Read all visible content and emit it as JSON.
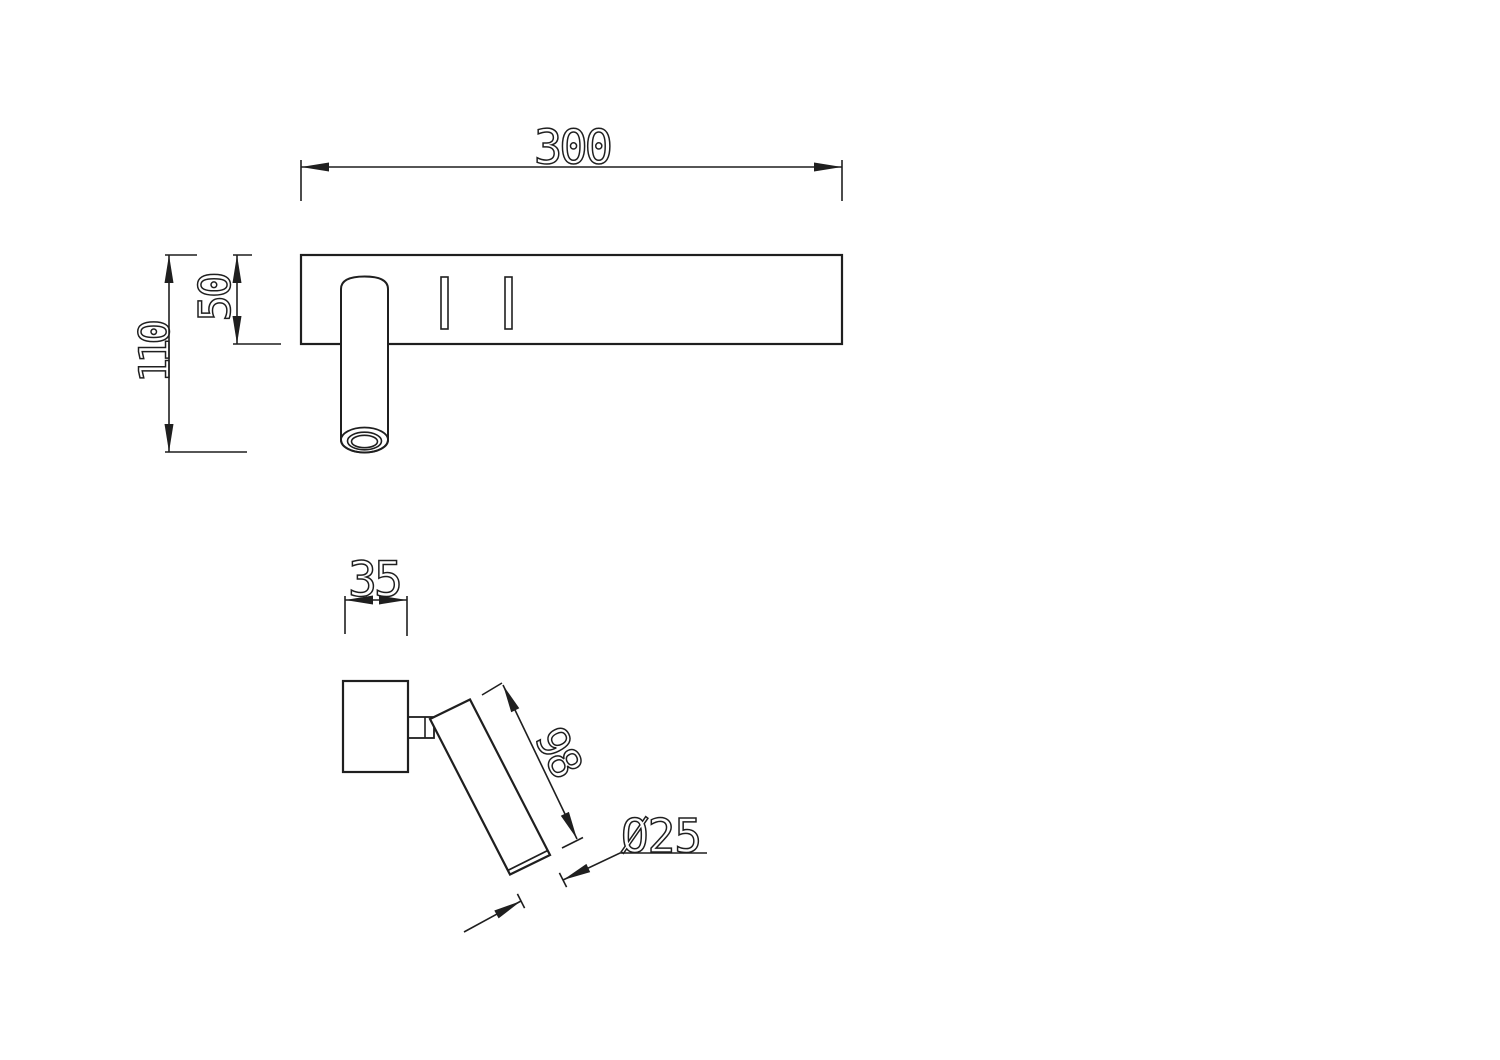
{
  "drawing": {
    "background_color": "#ffffff",
    "line_color": "#1f1f1f",
    "front_view": {
      "width": "300",
      "plate_height": "50",
      "total_height": "110"
    },
    "side_view": {
      "mount_width": "35",
      "head_length": "98",
      "head_diameter": "Ø25"
    }
  }
}
